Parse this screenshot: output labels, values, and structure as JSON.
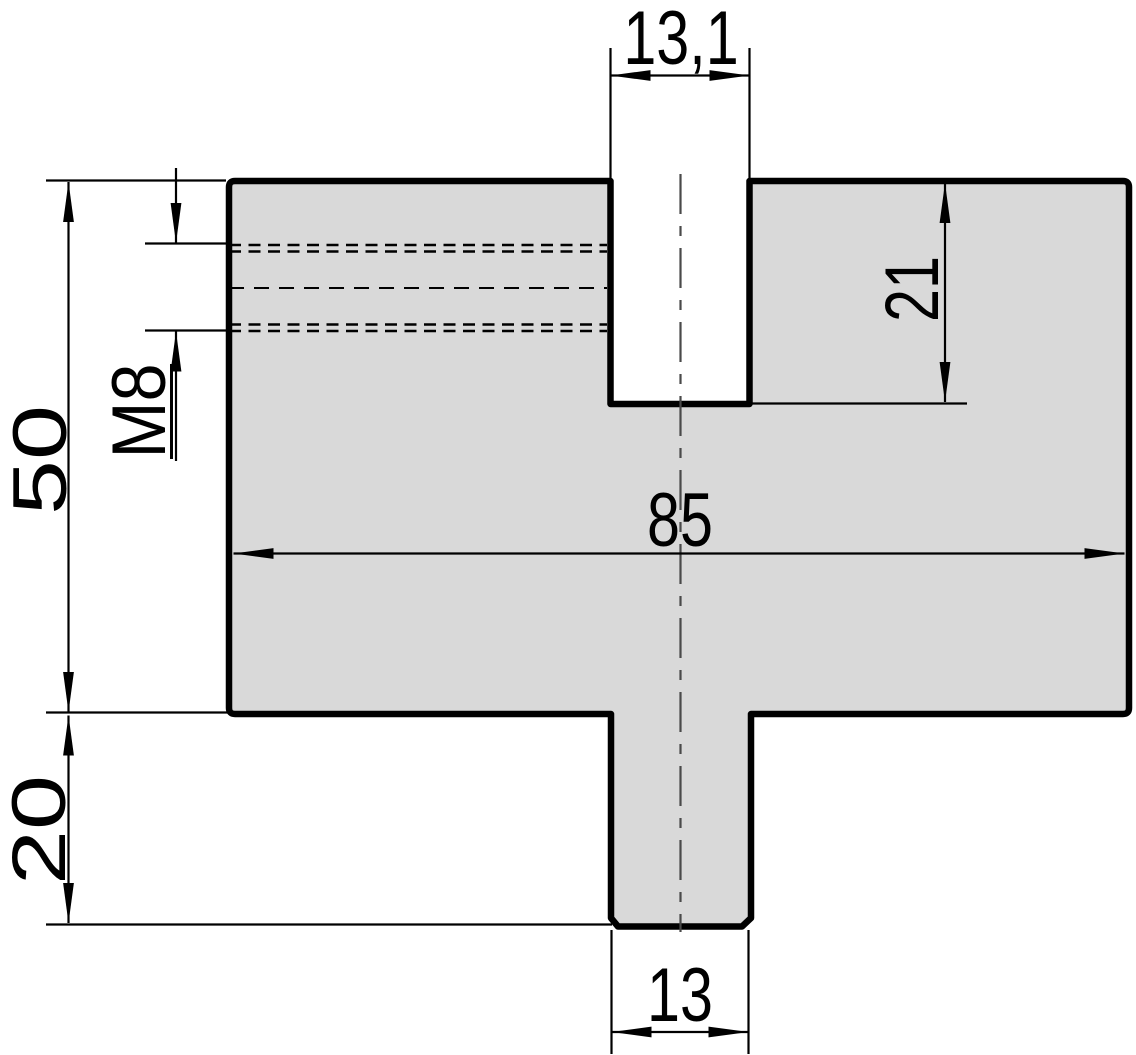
{
  "drawing": {
    "type": "technical-drawing",
    "description": "Cross-section of a press-brake die block with top slot, bottom tang and side M8 threaded hole",
    "units": "mm",
    "style": {
      "part_fill": "#d9d9d9",
      "outline_color": "#000000",
      "dimension_color": "#000000",
      "centerline_color": "#4a4a4a",
      "background": "#ffffff"
    },
    "dimensions": {
      "slot_width": {
        "label": "13,1",
        "value": 13.1
      },
      "slot_depth": {
        "label": "21",
        "value": 21
      },
      "body_height": {
        "label": "50",
        "value": 50
      },
      "thread": {
        "label": "M8"
      },
      "body_width": {
        "label": "85",
        "value": 85
      },
      "tang_height": {
        "label": "20",
        "value": 20
      },
      "tang_width": {
        "label": "13",
        "value": 13
      }
    }
  }
}
